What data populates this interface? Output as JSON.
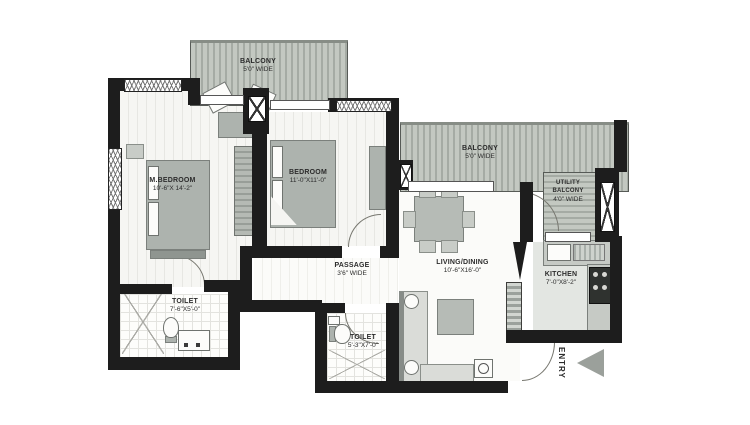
{
  "rooms": {
    "balcony_top": {
      "name": "BALCONY",
      "dims": "5'0\" WIDE"
    },
    "m_bedroom": {
      "name": "M.BEDROOM",
      "dims": "10'-6\"X 14'-2\""
    },
    "bedroom": {
      "name": "BEDROOM",
      "dims": "11'-0\"X11'-0\""
    },
    "balcony_mid": {
      "name": "BALCONY",
      "dims": "5'0\" WIDE"
    },
    "utility_balcony": {
      "line1": "UTILITY",
      "line2": "BALCONY",
      "dims": "4'0\" WIDE"
    },
    "kitchen": {
      "name": "KITCHEN",
      "dims": "7'-0\"X8'-2\""
    },
    "living_dining": {
      "name": "LIVING/DINING",
      "dims": "10'-6\"X16'-0\""
    },
    "passage": {
      "name": "PASSAGE",
      "dims": "3'6\" WIDE"
    },
    "toilet_1": {
      "name": "TOILET",
      "dims": "7'-6\"X5'-0\""
    },
    "toilet_2": {
      "name": "TOILET",
      "dims": "5'-3\"X7'-0\""
    }
  },
  "entry": {
    "label": "ENTRY"
  },
  "colors": {
    "wall": "#1d1d1d",
    "balcony_floor": "#b4bab3",
    "furniture": "#adb3ae",
    "entry_arrow": "#9ba09b",
    "background": "#ffffff"
  }
}
